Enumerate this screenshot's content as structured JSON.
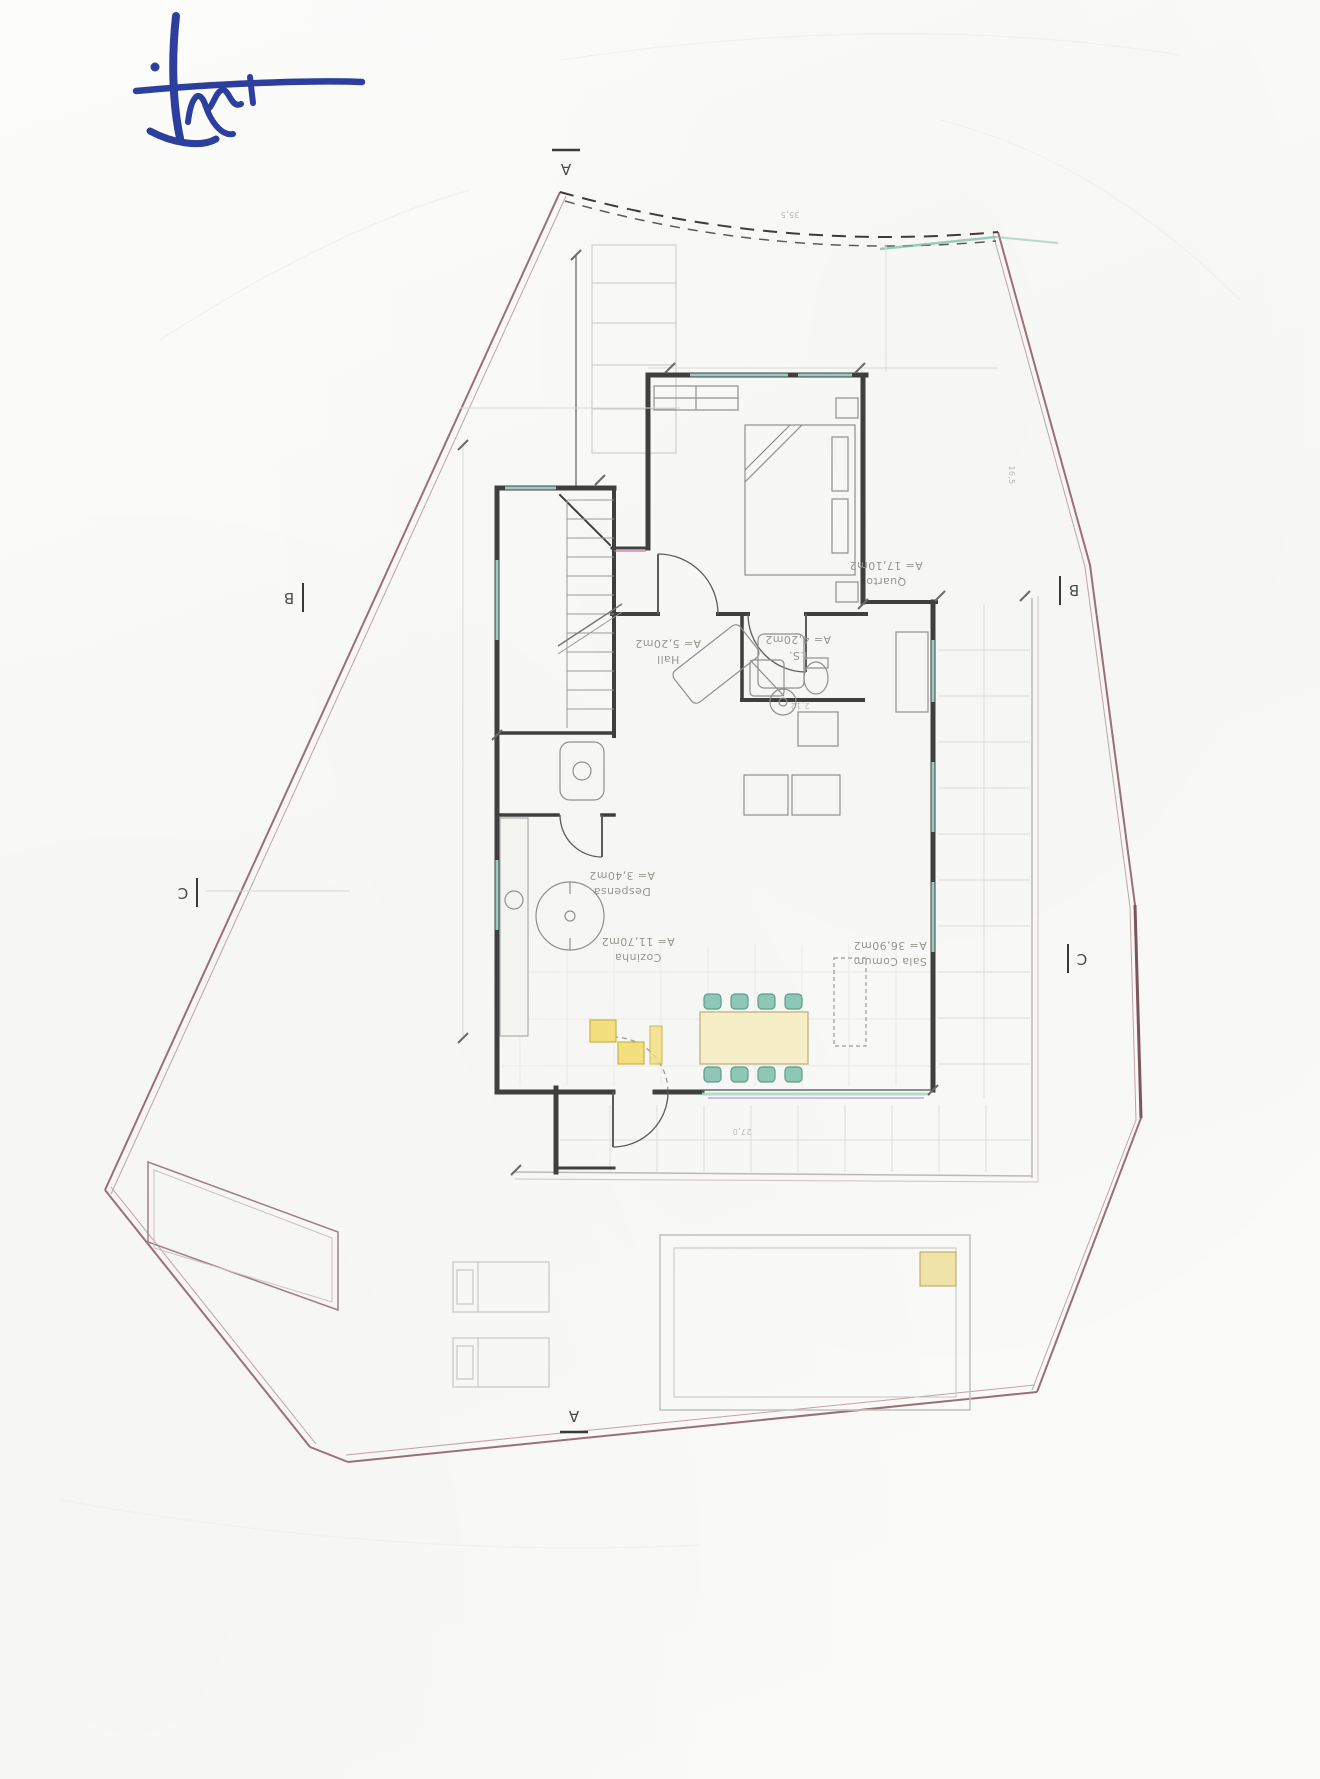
{
  "document": {
    "content": "Scanned architectural ground-floor plan, drawing rotated 180 degrees on page"
  },
  "signature": {
    "description": "handwritten initials in blue ballpoint ink",
    "ink_color": "#2c3f9f"
  },
  "section_markers": {
    "top": "A",
    "bottom": "A",
    "left_upper": "B",
    "right_upper": "B",
    "left_lower": "C",
    "right_lower": "C"
  },
  "rooms": [
    {
      "id": "quarto",
      "name": "Quarto",
      "area": "A= 17,10m2"
    },
    {
      "id": "hall",
      "name": "Hall",
      "area": "A= 5,20m2"
    },
    {
      "id": "is",
      "name": "I.S.",
      "area": "A= 4,20m2"
    },
    {
      "id": "despensa",
      "name": "Despensa",
      "area": "A= 3,40m2"
    },
    {
      "id": "cozinha",
      "name": "Cozinha",
      "area": "A= 11,70m2"
    },
    {
      "id": "sala",
      "name": "Sala Comum",
      "area": "A= 36,90m2"
    }
  ],
  "dimensions": [
    "35,5",
    "16,5",
    "27,0",
    "2,12"
  ],
  "colors": {
    "boundary": "#9b6f75",
    "boundary_light": "#c4a2a6",
    "wall": "#3f3f3f",
    "window_glass": "#a8d8cf",
    "door_threshold_tint": "#c9689a",
    "highlight_yellow": "#f3df7d",
    "chair_green": "#8fc7b6",
    "table_fill": "#f6eec6"
  }
}
